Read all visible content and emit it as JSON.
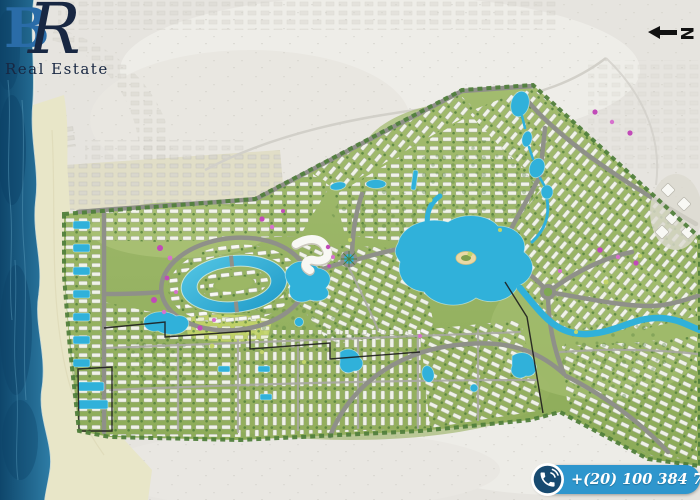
{
  "branding": {
    "monogram_b": "B",
    "monogram_r": "R",
    "name": "Real Estate"
  },
  "compass": {
    "label": "N"
  },
  "contact": {
    "phone": "+(20) 100 384 7187",
    "icon": "phone-icon"
  },
  "map": {
    "type": "real-estate-masterplan-aerial",
    "features": [
      "sea",
      "beach",
      "desert",
      "existing-settlement",
      "masterplan",
      "oval-lagoon-ring",
      "grand-lagoon",
      "winding-canal",
      "lake-chain",
      "ponds",
      "chalet-pools",
      "roads",
      "roundabouts",
      "housing-clusters",
      "flowering-trees",
      "beach-club",
      "event-tents",
      "phase-boundaries"
    ]
  },
  "colors": {
    "sea": "#15587f",
    "sea_deep": "#0c4166",
    "sea_light": "#5799ba",
    "sand": "#e8e6c8",
    "desert": "#e6e4df",
    "desert_light": "#eeede8",
    "green": "#9db566",
    "green_dark": "#4f7d3a",
    "green_lime": "#c2d469",
    "road": "#8f9089",
    "road_minor": "#a8a9a2",
    "water": "#30b1da",
    "water_light": "#7fd4ea",
    "building": "#f8f8f4",
    "building_edge": "#9aa08e",
    "flower": "#c14ab8",
    "flower_light": "#d671cd",
    "boundary": "#1d1d1d",
    "pill": "#2e96cd",
    "pill_icon": "#174a70",
    "logo_blue": "#2a6ca8",
    "logo_navy": "#182742",
    "arrow": "#111111",
    "white": "#ffffff"
  }
}
